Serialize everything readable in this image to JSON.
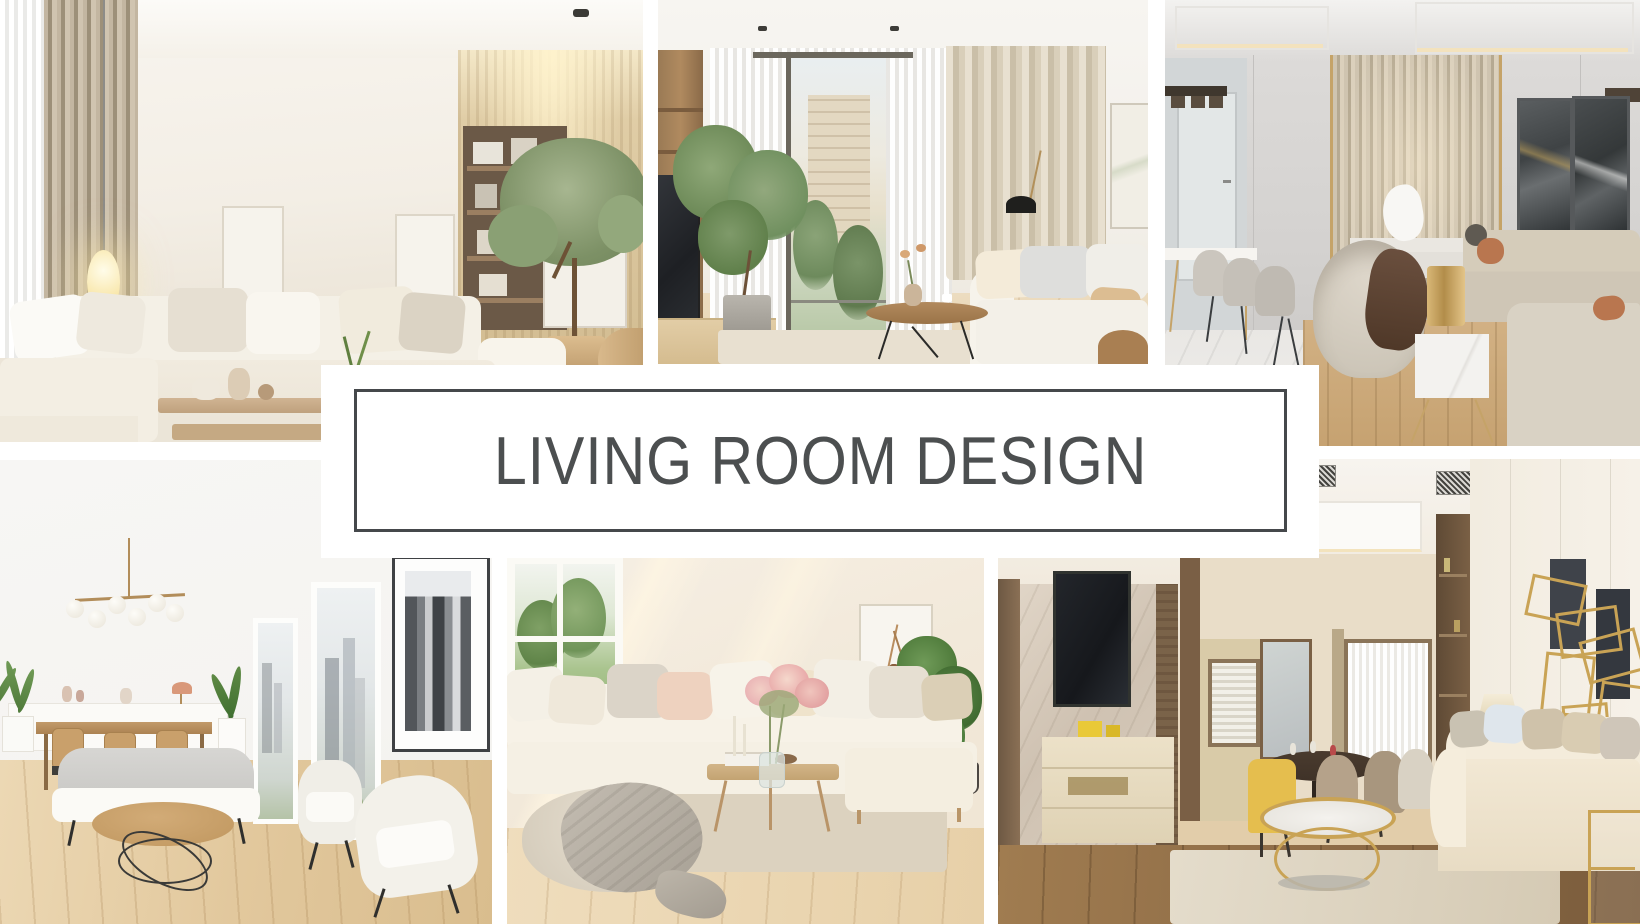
{
  "page": {
    "kind": "interior design photo collage",
    "background": "#ffffff",
    "width": 1640,
    "height": 924
  },
  "banner": {
    "title": "LIVING ROOM DESIGN",
    "background": "#ffffff",
    "border_color": "#45484b",
    "text_color": "#4c4f50"
  },
  "palette": {
    "cream": "#f3eee5",
    "taupe": "#9d9079",
    "wood": "#c9a36e",
    "brass": "#c9a355",
    "charcoal": "#45484b",
    "foliage": "#7c9065"
  },
  "photos": [
    {
      "id": "top-left",
      "description": "Modern beige living room with cream L-shaped sectional sofa, glowing egg pendant lamp, sheer and taupe curtains, wooden shelving niche with books, indoor tree in wooden planter and two-tier light-wood coffee table"
    },
    {
      "id": "top-middle",
      "description": "Bright living room with sheer floor-to-ceiling curtains and city-view window, tall potted ficus, wood media wall with TV, beige drape curtains, white sofa with gray pillows and round wooden coffee table on black legs"
    },
    {
      "id": "top-right",
      "description": "Luxury greige lounge with champagne slatted feature wall, gold trims, dark abstract art panels, white dining table with upholstered chairs, curved swivel armchair with brown throw, brass cylinder lamp on marble cube and long beige sofas on marble floor with wood rug"
    },
    {
      "id": "bottom-left",
      "description": "Scandinavian white living-dining room with brass globe chandelier, white credenza, wooden dining table and chairs, tall windows with black-and-white city view, framed monochrome skyline poster, gray sofa, two cream armchairs and round wood coffee table on black wire base over light oak floor"
    },
    {
      "id": "bottom-middle",
      "description": "Sunlit cozy living room with cream sectional sofa and blush pillows, slim wooden coffee table with pink blossom bouquet and candles, garden window, wall shelf with framed branch art and vases, leafy houseplant, gray throw on pouf and pale plank floor"
    },
    {
      "id": "bottom-right",
      "description": "Warm contemporary lounge with marble TV feature wall and dark wood trim, cream media cabinet, recessed ceiling with vents, dining nook with yellow and taupe chairs, round marble coffee table with brass frame, gold geometric wall sculpture and beige sofa on dark wood floor"
    }
  ]
}
